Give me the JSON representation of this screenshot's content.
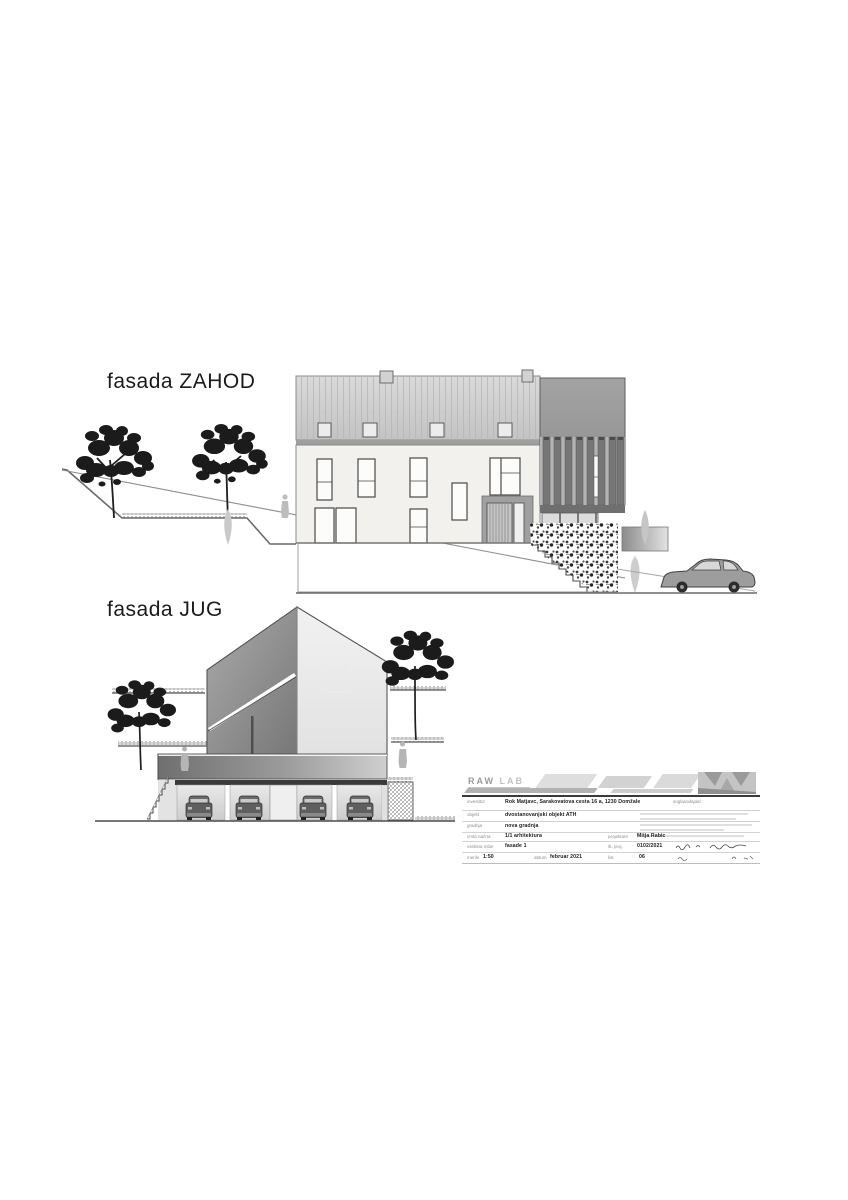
{
  "labels": {
    "west_facade": "fasada ZAHOD",
    "south_facade": "fasada JUG"
  },
  "titleblock": {
    "logo": {
      "text": "RAW",
      "text2": "LAB"
    },
    "signatories_label": "soglasodajalci",
    "rows": [
      {
        "label": "investitor",
        "value": "Rok Matjavc, Sarakovatova cesta 16 a, 1230 Domžale"
      },
      {
        "label": "objekt",
        "value": "dvostanovanjski objekt ATH"
      },
      {
        "label": "gradnja",
        "value": "nova gradnja"
      },
      {
        "label": "vrsta načrta",
        "value": "1/1 arhitektura"
      }
    ],
    "projektant": {
      "label": "projektant",
      "value": "Mitja Rabic"
    },
    "content_row": {
      "label": "vsebina risbe",
      "value": "fasade 1",
      "proj_label": "št. proj.",
      "proj_value": "0102/2021"
    },
    "scale_row": {
      "merilo_label": "merilo",
      "merilo_value": "1:50",
      "datum_label": "datum",
      "datum_value": "februar 2021",
      "list_label": "list",
      "list_value": "06"
    }
  },
  "colors": {
    "line": "#4a4a4a",
    "roof": "#cdcdcd",
    "facade": "#f2f1ee",
    "tower": "#909090",
    "slat": "#767676",
    "foliage": "#1b1b1b",
    "ghost": "#c4c4c4",
    "slab_dark": "#7a7a7a",
    "slab_light": "#cfcfcf"
  }
}
